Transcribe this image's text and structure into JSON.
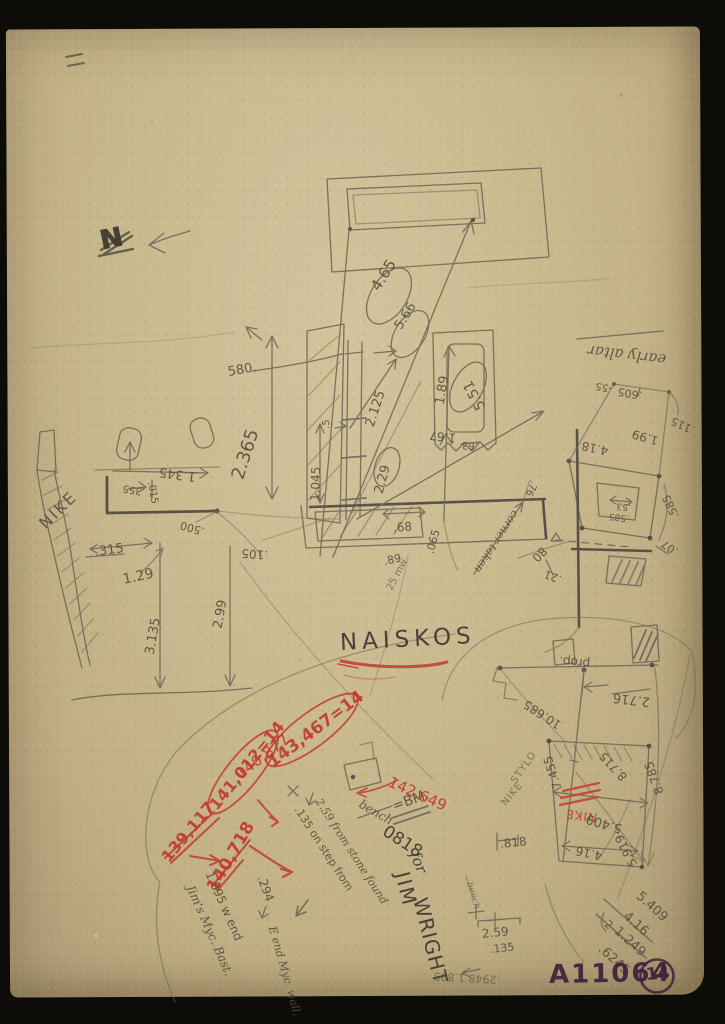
{
  "colors": {
    "paper": "#cab990",
    "pencil": "#56503f",
    "pencil_dark": "#3d382f",
    "red": "#c23a2e",
    "stamp_ink": "#40203a"
  },
  "labels": {
    "north": {
      "n": "N"
    },
    "title": {
      "naiskos": "NAISKOS"
    },
    "plan": {
      "d465": "4.65",
      "d566": "5.66"
    },
    "elev": {
      "d580": "580.",
      "d2365": "2.365",
      "d2125": "2.125",
      "d551": "5.51",
      "d229": "2.29",
      "d1045": "1.045",
      "d5": ".5",
      "d68": ".68",
      "d89": ".89",
      "d105": ".105",
      "d065": ".065",
      "d25mw": "25 mw",
      "d189": "1.89",
      "d167": "1.67",
      "d63": ".63"
    },
    "nike": {
      "name": "NIKE",
      "d1345": "1.345",
      "d355": ".355",
      "d015": ".015",
      "d500": ".500",
      "d315": ".315",
      "d129": "1.29",
      "d3135": "3.135",
      "d299": "2.99"
    },
    "altar": {
      "title": "early altar",
      "d605": ".605",
      "d55": "-55",
      "d115": ".115",
      "d199": "1.99",
      "d418": "4.18",
      "d585a": ".585",
      "d53": ".53",
      "d585b": ".585",
      "d07": ".07",
      "d21": ".21",
      "corner": "corner taken",
      "d76": ".76",
      "d80": "80"
    },
    "levels": {
      "l143467": "143,467=14",
      "l140877": "140,877",
      "l141012": "141,012=14",
      "l139117": "139,117",
      "l140718": "140,718",
      "l142649": "142,649",
      "nike_red": "NIKE"
    },
    "bm": {
      "bm": "=BM.",
      "bench": "bench",
      "num": "0818",
      "note135": ".135 on step from",
      "note259": "2.59 from stone found",
      "for": "for",
      "jim": "JIM",
      "wright": "WRIGHT",
      "w_end": "1.895 w end",
      "jims_bast": "Jim's Myc. Bast.",
      "e_val": ".294",
      "e_end": "E end Myc. wall.",
      "bench_small": "bench",
      "d259": "2.59",
      "d135": ".135",
      "flipped": ".2948 1.895",
      "d818": ".818"
    },
    "bastion": {
      "prop": "prop.",
      "d10685": "10.685",
      "d2716": "2.716",
      "d7455": "7.455",
      "d8715": "8.715",
      "d8785": "8.785",
      "d5409": "5.409",
      "d5919": "5.919",
      "d416": "4.16",
      "stylo": "STYLO",
      "nike2": "NIKE"
    },
    "arith": {
      "a": "5.409",
      "b": "4.16",
      "div": "2",
      "c": "1.249",
      "d": ".6245"
    },
    "stamp": {
      "code": "A11064",
      "num": "14"
    }
  }
}
